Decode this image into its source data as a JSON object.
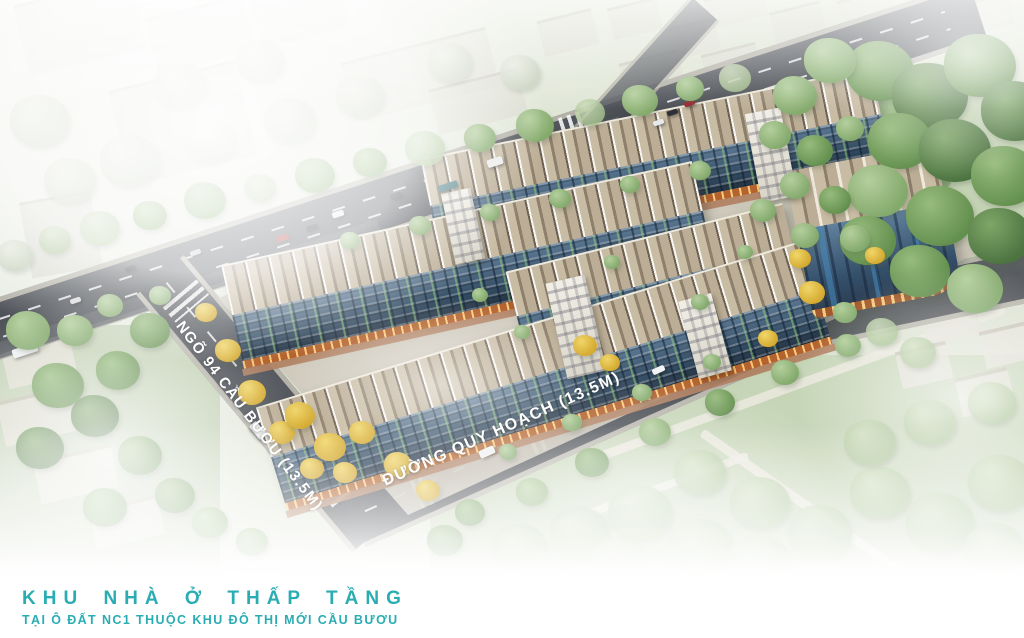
{
  "footer": {
    "title": "KHU NHÀ Ở THẤP TẦNG",
    "subtitle": "TẠI Ô ĐẤT NC1 THUỘC KHU ĐÔ THỊ MỚI CẦU BƯƠU",
    "accent_color": "#2aadb2"
  },
  "road_labels": {
    "left_road": "NGÕ 94 CẦU BƯƠU (13.5M)",
    "front_road": "ĐƯỜNG QUY HOẠCH (13.5M)",
    "text_color": "#ffffff"
  },
  "palette": {
    "asphalt": "#4a4e54",
    "roof_tan": "#c1b29a",
    "facade_blue": "#3c5570",
    "shopfront_orange": "#b4622e",
    "brick_walk": "#b08060",
    "lawn_green": "#8fb475",
    "foliage_yellow": "#e3bf3f",
    "fog_white": "#ffffff"
  },
  "scene": {
    "trees": [
      [
        15,
        255,
        18,
        "p"
      ],
      [
        55,
        240,
        16,
        "g4"
      ],
      [
        100,
        228,
        20,
        "g4"
      ],
      [
        150,
        215,
        17,
        "g3"
      ],
      [
        205,
        200,
        21,
        "g3"
      ],
      [
        260,
        188,
        16,
        "g4"
      ],
      [
        315,
        175,
        20,
        "g3"
      ],
      [
        370,
        162,
        17,
        "g3"
      ],
      [
        425,
        148,
        20,
        "g4"
      ],
      [
        480,
        138,
        16,
        "g3"
      ],
      [
        535,
        125,
        19,
        "g3"
      ],
      [
        590,
        112,
        15,
        "g4"
      ],
      [
        640,
        100,
        18,
        "g3"
      ],
      [
        690,
        88,
        14,
        "g3"
      ],
      [
        735,
        78,
        16,
        "g4"
      ],
      [
        70,
        180,
        26,
        "p"
      ],
      [
        130,
        160,
        30,
        "p"
      ],
      [
        210,
        140,
        26,
        "p"
      ],
      [
        40,
        120,
        30,
        "p"
      ],
      [
        290,
        120,
        26,
        "p"
      ],
      [
        360,
        95,
        24,
        "p"
      ],
      [
        450,
        62,
        22,
        "p"
      ],
      [
        520,
        72,
        20,
        "p"
      ],
      [
        260,
        60,
        24,
        "p"
      ],
      [
        180,
        85,
        26,
        "p"
      ],
      [
        110,
        305,
        13,
        "g3"
      ],
      [
        160,
        295,
        11,
        "g3"
      ],
      [
        350,
        240,
        10,
        "g3"
      ],
      [
        420,
        225,
        11,
        "g3"
      ],
      [
        490,
        212,
        10,
        "g3"
      ],
      [
        560,
        198,
        11,
        "g3"
      ],
      [
        630,
        184,
        10,
        "g3"
      ],
      [
        700,
        170,
        11,
        "g3"
      ],
      [
        880,
        70,
        34,
        "g2"
      ],
      [
        930,
        95,
        38,
        "g1"
      ],
      [
        980,
        65,
        36,
        "g2"
      ],
      [
        1015,
        110,
        34,
        "g1"
      ],
      [
        900,
        140,
        32,
        "g2"
      ],
      [
        955,
        150,
        36,
        "g1"
      ],
      [
        1005,
        175,
        34,
        "g2"
      ],
      [
        878,
        190,
        30,
        "g3"
      ],
      [
        940,
        215,
        34,
        "g2"
      ],
      [
        1000,
        235,
        32,
        "g1"
      ],
      [
        868,
        240,
        28,
        "g2"
      ],
      [
        920,
        270,
        30,
        "g2"
      ],
      [
        975,
        288,
        28,
        "g3"
      ],
      [
        830,
        60,
        26,
        "g3"
      ],
      [
        795,
        95,
        22,
        "g3"
      ],
      [
        775,
        135,
        16,
        "g3"
      ],
      [
        815,
        150,
        18,
        "g2"
      ],
      [
        850,
        128,
        14,
        "g3"
      ],
      [
        795,
        185,
        15,
        "g3"
      ],
      [
        835,
        200,
        16,
        "g2"
      ],
      [
        805,
        235,
        14,
        "g3"
      ],
      [
        763,
        210,
        13,
        "g3"
      ],
      [
        855,
        238,
        15,
        "g3"
      ],
      [
        800,
        258,
        11,
        "y"
      ],
      [
        812,
        292,
        13,
        "y"
      ],
      [
        768,
        338,
        10,
        "y"
      ],
      [
        845,
        312,
        12,
        "g3"
      ],
      [
        882,
        332,
        16,
        "g4"
      ],
      [
        918,
        352,
        18,
        "g4"
      ],
      [
        875,
        255,
        10,
        "y"
      ],
      [
        150,
        330,
        20,
        "g2"
      ],
      [
        118,
        370,
        22,
        "g2"
      ],
      [
        95,
        415,
        24,
        "g1"
      ],
      [
        140,
        455,
        22,
        "g2"
      ],
      [
        175,
        495,
        20,
        "g2"
      ],
      [
        58,
        385,
        26,
        "g2"
      ],
      [
        40,
        447,
        24,
        "g1"
      ],
      [
        105,
        507,
        22,
        "g2"
      ],
      [
        210,
        522,
        18,
        "g3"
      ],
      [
        252,
        542,
        16,
        "g3"
      ],
      [
        28,
        330,
        22,
        "g3"
      ],
      [
        75,
        330,
        18,
        "g3"
      ],
      [
        206,
        312,
        11,
        "y"
      ],
      [
        228,
        350,
        13,
        "y"
      ],
      [
        252,
        392,
        14,
        "y"
      ],
      [
        282,
        432,
        13,
        "y"
      ],
      [
        312,
        468,
        12,
        "y"
      ],
      [
        300,
        415,
        15,
        "y"
      ],
      [
        330,
        447,
        16,
        "y"
      ],
      [
        362,
        432,
        13,
        "y"
      ],
      [
        345,
        472,
        12,
        "y"
      ],
      [
        398,
        464,
        14,
        "y"
      ],
      [
        428,
        490,
        12,
        "y"
      ],
      [
        585,
        345,
        12,
        "y"
      ],
      [
        610,
        362,
        10,
        "y"
      ],
      [
        470,
        512,
        15,
        "g2"
      ],
      [
        532,
        492,
        16,
        "g3"
      ],
      [
        592,
        462,
        17,
        "g2"
      ],
      [
        655,
        432,
        16,
        "g3"
      ],
      [
        720,
        402,
        15,
        "g2"
      ],
      [
        785,
        372,
        14,
        "g3"
      ],
      [
        848,
        345,
        13,
        "g3"
      ],
      [
        445,
        540,
        18,
        "g2"
      ],
      [
        508,
        452,
        9,
        "g3"
      ],
      [
        572,
        422,
        10,
        "g3"
      ],
      [
        642,
        392,
        10,
        "g3"
      ],
      [
        712,
        362,
        9,
        "g3"
      ],
      [
        520,
        548,
        28,
        "g4"
      ],
      [
        580,
        532,
        30,
        "g4"
      ],
      [
        640,
        512,
        32,
        "g4"
      ],
      [
        700,
        548,
        34,
        "g4"
      ],
      [
        760,
        502,
        30,
        "g4"
      ],
      [
        820,
        532,
        32,
        "g4"
      ],
      [
        880,
        492,
        30,
        "g4"
      ],
      [
        940,
        522,
        34,
        "g4"
      ],
      [
        1000,
        482,
        32,
        "g4"
      ],
      [
        870,
        442,
        26,
        "g4"
      ],
      [
        930,
        422,
        26,
        "g4"
      ],
      [
        992,
        402,
        24,
        "g4"
      ],
      [
        700,
        472,
        26,
        "g4"
      ],
      [
        620,
        562,
        30,
        "g4"
      ],
      [
        760,
        562,
        32,
        "g4"
      ],
      [
        995,
        548,
        30,
        "g4"
      ],
      [
        545,
        575,
        26,
        "g4"
      ],
      [
        660,
        575,
        28,
        "g4"
      ],
      [
        480,
        295,
        8,
        "g3"
      ],
      [
        612,
        262,
        8,
        "g3"
      ],
      [
        700,
        302,
        9,
        "g3"
      ],
      [
        745,
        252,
        8,
        "g3"
      ],
      [
        522,
        332,
        8,
        "g3"
      ]
    ],
    "cars": [
      [
        75,
        300,
        -18,
        11,
        5,
        "#d9dad9"
      ],
      [
        130,
        268,
        -18,
        11,
        5,
        "#34383e"
      ],
      [
        195,
        252,
        -18,
        11,
        5,
        "#c9cac9"
      ],
      [
        282,
        238,
        -18,
        13,
        6,
        "#a93036"
      ],
      [
        312,
        228,
        -18,
        12,
        6,
        "#2c2f36"
      ],
      [
        338,
        214,
        -18,
        12,
        6,
        "#e8e9ea"
      ],
      [
        396,
        196,
        -18,
        12,
        6,
        "#33373d"
      ],
      [
        448,
        186,
        -18,
        20,
        7,
        "#4f8089"
      ],
      [
        495,
        162,
        -18,
        16,
        8,
        "#ececec"
      ],
      [
        658,
        122,
        -18,
        11,
        5,
        "#e8e9ea"
      ],
      [
        672,
        112,
        -18,
        11,
        5,
        "#2c2f36"
      ],
      [
        689,
        103,
        -18,
        11,
        5,
        "#9c2730"
      ],
      [
        25,
        350,
        -18,
        26,
        9,
        "#eef1f1"
      ],
      [
        258,
        430,
        50,
        18,
        9,
        "#f0f1f2"
      ],
      [
        658,
        370,
        -24,
        13,
        6,
        "#f2f3f4"
      ],
      [
        487,
        452,
        -24,
        16,
        8,
        "#eff0f1"
      ]
    ],
    "far_blocks": [
      [
        20,
        -10,
        120,
        70,
        -14,
        "a"
      ],
      [
        150,
        6,
        100,
        55,
        -14,
        "a"
      ],
      [
        255,
        -14,
        90,
        50,
        -14,
        "a"
      ],
      [
        118,
        74,
        130,
        95,
        -14,
        "b"
      ],
      [
        345,
        44,
        150,
        58,
        -14,
        "a"
      ],
      [
        25,
        196,
        72,
        74,
        -10,
        "b"
      ],
      [
        432,
        78,
        92,
        44,
        -14,
        "a"
      ],
      [
        540,
        14,
        56,
        34,
        -14,
        "a"
      ],
      [
        610,
        2,
        50,
        30,
        -14,
        "a"
      ],
      [
        672,
        22,
        46,
        30,
        -14,
        "a"
      ],
      [
        706,
        -8,
        60,
        28,
        -14,
        "a"
      ],
      [
        772,
        6,
        52,
        30,
        -14,
        "a"
      ],
      [
        840,
        -6,
        56,
        32,
        -14,
        "a"
      ],
      [
        905,
        10,
        48,
        28,
        -14,
        "a"
      ],
      [
        962,
        -2,
        50,
        30,
        -14,
        "a"
      ],
      [
        622,
        56,
        60,
        34,
        -14,
        "a"
      ],
      [
        704,
        48,
        56,
        32,
        -14,
        "a"
      ],
      [
        862,
        276,
        50,
        34,
        -13,
        "c"
      ],
      [
        922,
        300,
        56,
        36,
        -13,
        "c"
      ],
      [
        982,
        326,
        50,
        34,
        -13,
        "c"
      ],
      [
        898,
        346,
        52,
        34,
        -13,
        "c"
      ],
      [
        958,
        372,
        54,
        36,
        -13,
        "c"
      ],
      [
        1000,
        270,
        40,
        30,
        -13,
        "c"
      ],
      [
        4,
        340,
        70,
        38,
        -13,
        "c"
      ],
      [
        0,
        392,
        85,
        42,
        -13,
        "c"
      ],
      [
        36,
        452,
        80,
        40,
        -13,
        "c"
      ],
      [
        92,
        502,
        70,
        36,
        -13,
        "c"
      ]
    ]
  }
}
